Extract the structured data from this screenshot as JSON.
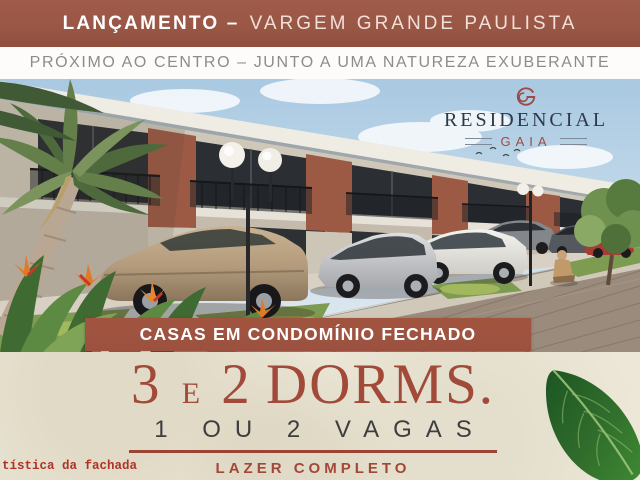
{
  "top_banner": {
    "highlight": "LANÇAMENTO –",
    "rest": "VARGEM GRANDE PAULISTA"
  },
  "sub_banner": {
    "text": "PRÓXIMO AO CENTRO – JUNTO A UMA NATUREZA EXUBERANTE"
  },
  "hero": {
    "alt": "3D architectural rendering of two-story townhouses with black balcony railings, globe lamps, parked cars, palm tree, tropical flowers and brick-paved walkway"
  },
  "logo": {
    "monogram": "G",
    "name": "RESIDENCIAL",
    "subname": "GAIA"
  },
  "ribbon": {
    "text": "CASAS EM CONDOMÍNIO FECHADO"
  },
  "headline": {
    "num1": "3",
    "conj": "E",
    "num2": "2",
    "word": "DORMS."
  },
  "subheadline": {
    "text": "1 OU 2 VAGAS"
  },
  "tagline": {
    "text": "LAZER COMPLETO"
  },
  "disclaimer": {
    "text": "tística da fachada"
  },
  "colors": {
    "terracotta_banner": "#9A5746",
    "ribbon": "#9C5140",
    "cream": "#ECE7D7",
    "headline_maroon": "#A24A3A",
    "subheadline_charcoal": "#3E3E3E",
    "logo_navy": "#2D3949",
    "logo_maroon": "#9C4B46",
    "disclaimer_red": "#B03325",
    "leaf_green": "#2F6B2B"
  }
}
